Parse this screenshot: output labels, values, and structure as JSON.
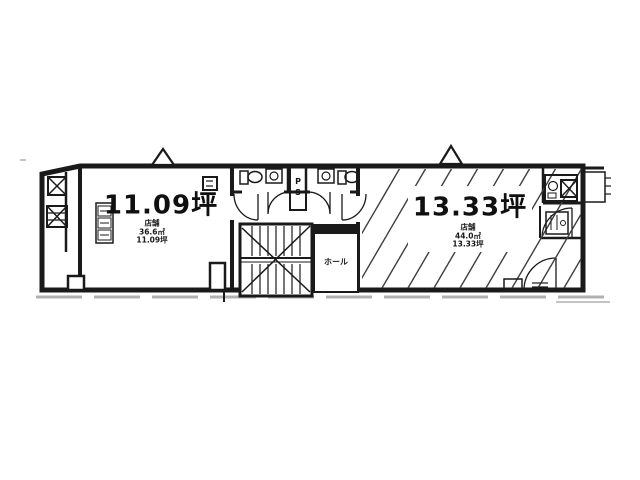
{
  "colors": {
    "background": "#ffffff",
    "ink": "#1a1a1a",
    "shadow_line": "#b0b0b0",
    "hatch_line": "#3f3f3f"
  },
  "floorplan": {
    "left_room": {
      "area_label": "11.09坪",
      "sub_lines": [
        "店舗",
        "36.6㎡",
        "11.09坪"
      ]
    },
    "right_room": {
      "area_label": "13.33坪",
      "sub_lines": [
        "店舗",
        "44.0㎡",
        "13.33坪"
      ]
    },
    "core": {
      "pipe_space_label": "PS",
      "hall_label": "ホール"
    },
    "icons": {
      "stair_icon": "staircase-with-cross-lines",
      "shaft_icon": "box-with-x",
      "hatched_shaft_icon": "box-with-x-and-fill-lines",
      "toilet_icon": "toilet-bowl-and-tank",
      "sink_icon": "basin-box-with-circle",
      "door_icon": "quarter-arc-door-swing",
      "entrance_icon": "triangle-entry-marker",
      "kitchenette_icon": "stacked-unit-boxes",
      "counter_icon": "counter-with-sink-circle"
    }
  }
}
